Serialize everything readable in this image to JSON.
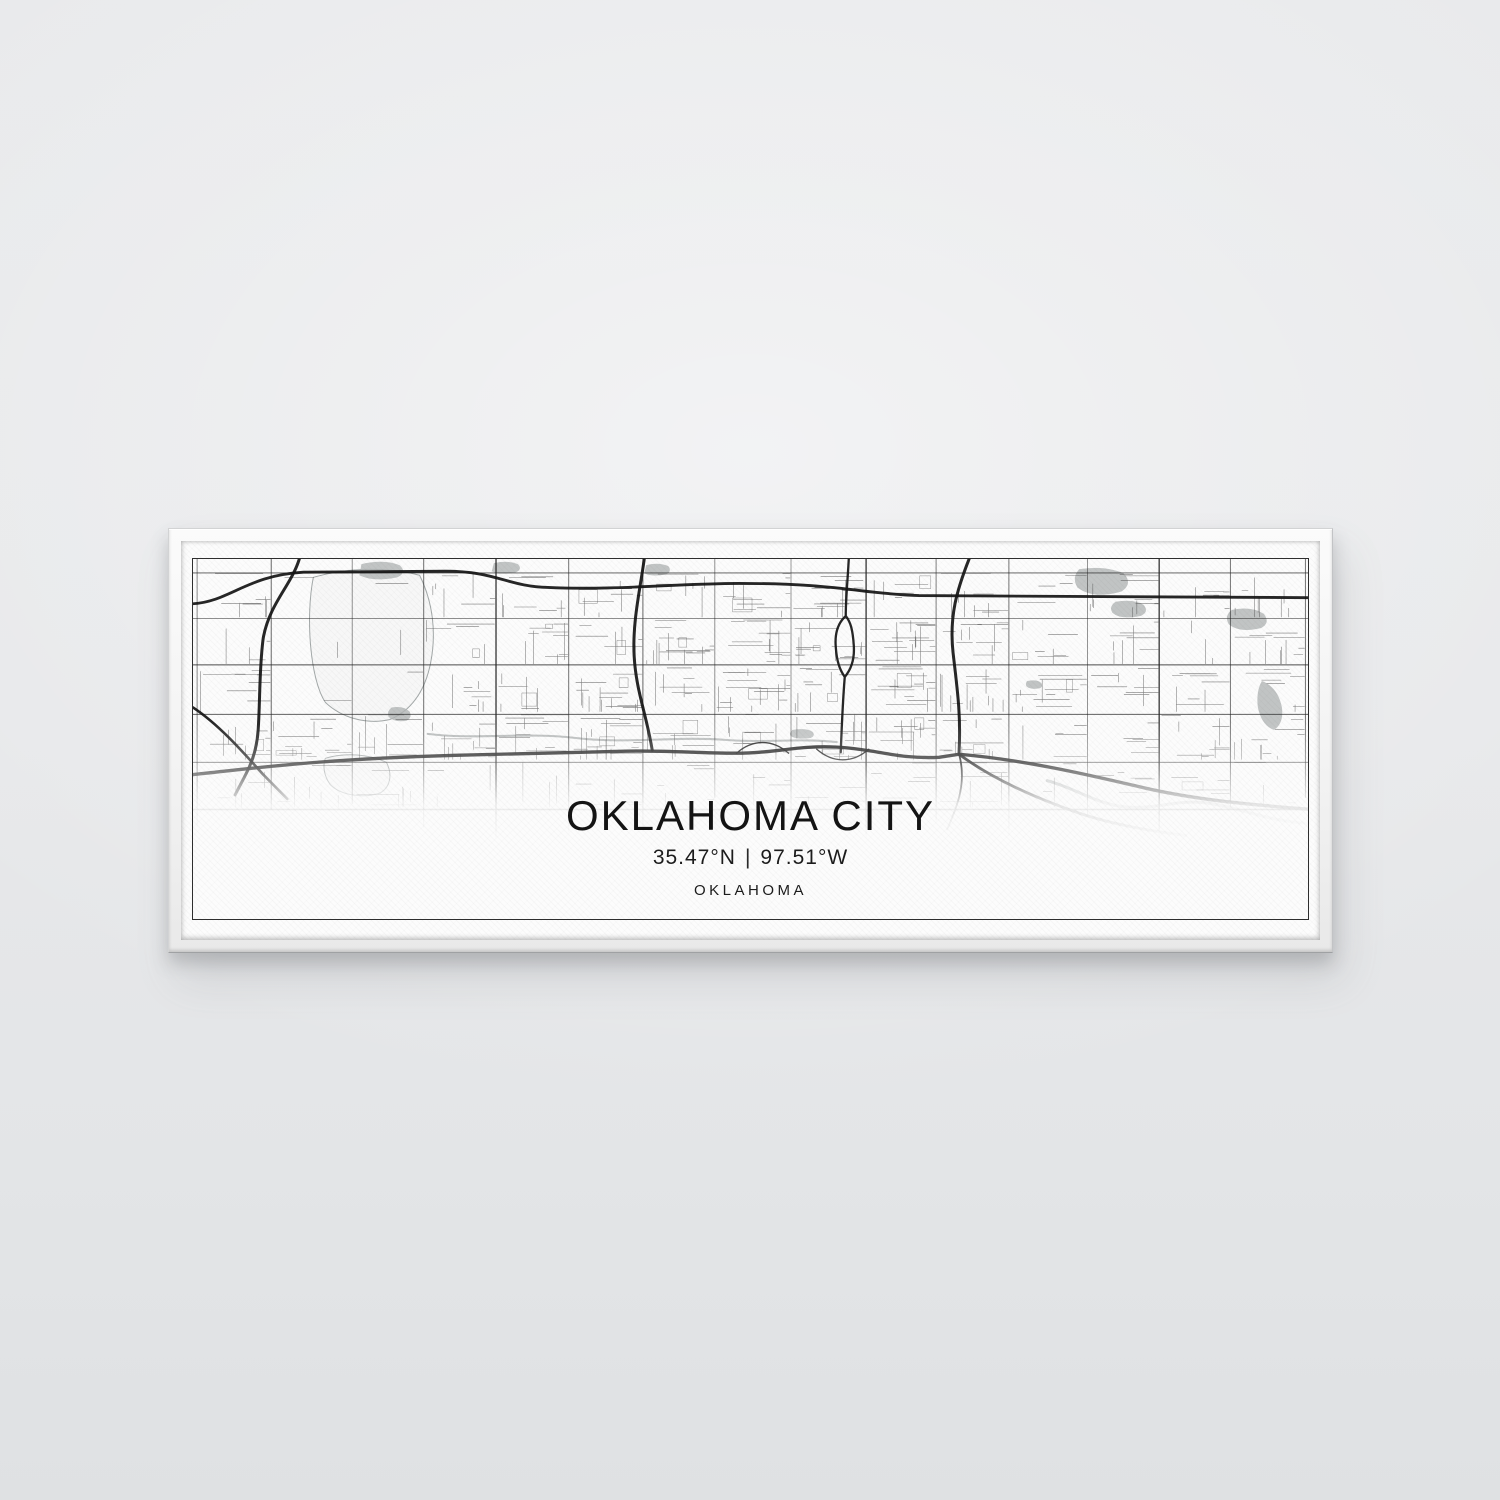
{
  "scene": {
    "wall_color": "#e7e9ea",
    "frame_color": "#f3f3f3",
    "canvas_color": "#fcfcfc"
  },
  "artwork": {
    "title": "OKLAHOMA CITY",
    "latitude": "35.47°N",
    "separator": "|",
    "longitude": "97.51°W",
    "region": "OKLAHOMA"
  },
  "map_style": {
    "grid_road_color": "#262626",
    "minor_road_color": "#4a4a4a",
    "highway_color": "#141414",
    "water_color": "#9aa0a0",
    "river_color": "#b3b6b6",
    "park_color": "#b2b5b5",
    "background": "#fcfcfc",
    "border_color": "#2e2e2e"
  }
}
